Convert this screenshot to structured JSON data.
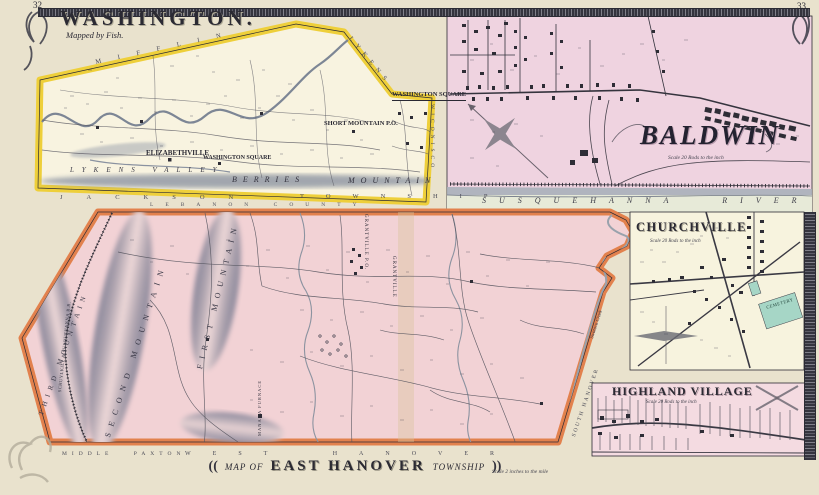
{
  "page": {
    "left_number": "32",
    "right_number": "33"
  },
  "washington": {
    "title": "WASHINGTON.",
    "credit": "Mapped by Fish.",
    "inset_title": "WASHINGTON SQUARE",
    "boundary_top": "MIFFLIN",
    "boundary_northeast": "LYKENS",
    "boundary_east": "WICONISCO",
    "boundary_south_township": "JACKSON",
    "boundary_south_township2": "TOWNSHIP",
    "boundary_south_county": "LEBANON COUNTY",
    "valley": "LYKENS VALLEY",
    "mountain_word1": "BERRIES",
    "mountain_word2": "MOUNTAIN",
    "towns": {
      "elizabethville": "ELIZABETHVILLE",
      "washington_square": "WASHINGTON SQUARE",
      "short_mountain": "SHORT MOUNTAIN P.O."
    }
  },
  "baldwin": {
    "title": "BALDWIN",
    "scale_note": "Scale 20 Rods to the inch",
    "river": "SUSQUEHANNA RIVER"
  },
  "churchville": {
    "title": "CHURCHVILLE",
    "scale_note": "Scale 20 Rods to the inch",
    "cemetery": "CEMETERY"
  },
  "highland": {
    "title": "HIGHLAND VILLAGE",
    "scale_note": "Scale 20 Rods to the inch"
  },
  "east_hanover": {
    "cartouche": {
      "open": "((",
      "map_of": "MAP OF",
      "name": "EAST HANOVER",
      "township": "TOWNSHIP",
      "close": "))",
      "scale": "Scale 2 inches to the mile"
    },
    "mountains": {
      "first": "FIRST MOUNTAIN",
      "second": "SECOND MOUNTAIN",
      "third": "THIRD MOUNTAIN"
    },
    "railroad": "SCHUYLKILL & SUSQUEHANNA R.R.",
    "places": {
      "grantville_po": "GRANTVILLE P.O.",
      "grantville": "GRANTVILLE",
      "manada_furnace": "MANADA FURNACE"
    },
    "boundaries": {
      "middle_paxton": "MIDDLE PAXTON",
      "west_hanover": "WEST HANOVER",
      "south_hanover": "SOUTH HANOVER"
    },
    "creek": "Swatara Creek"
  }
}
